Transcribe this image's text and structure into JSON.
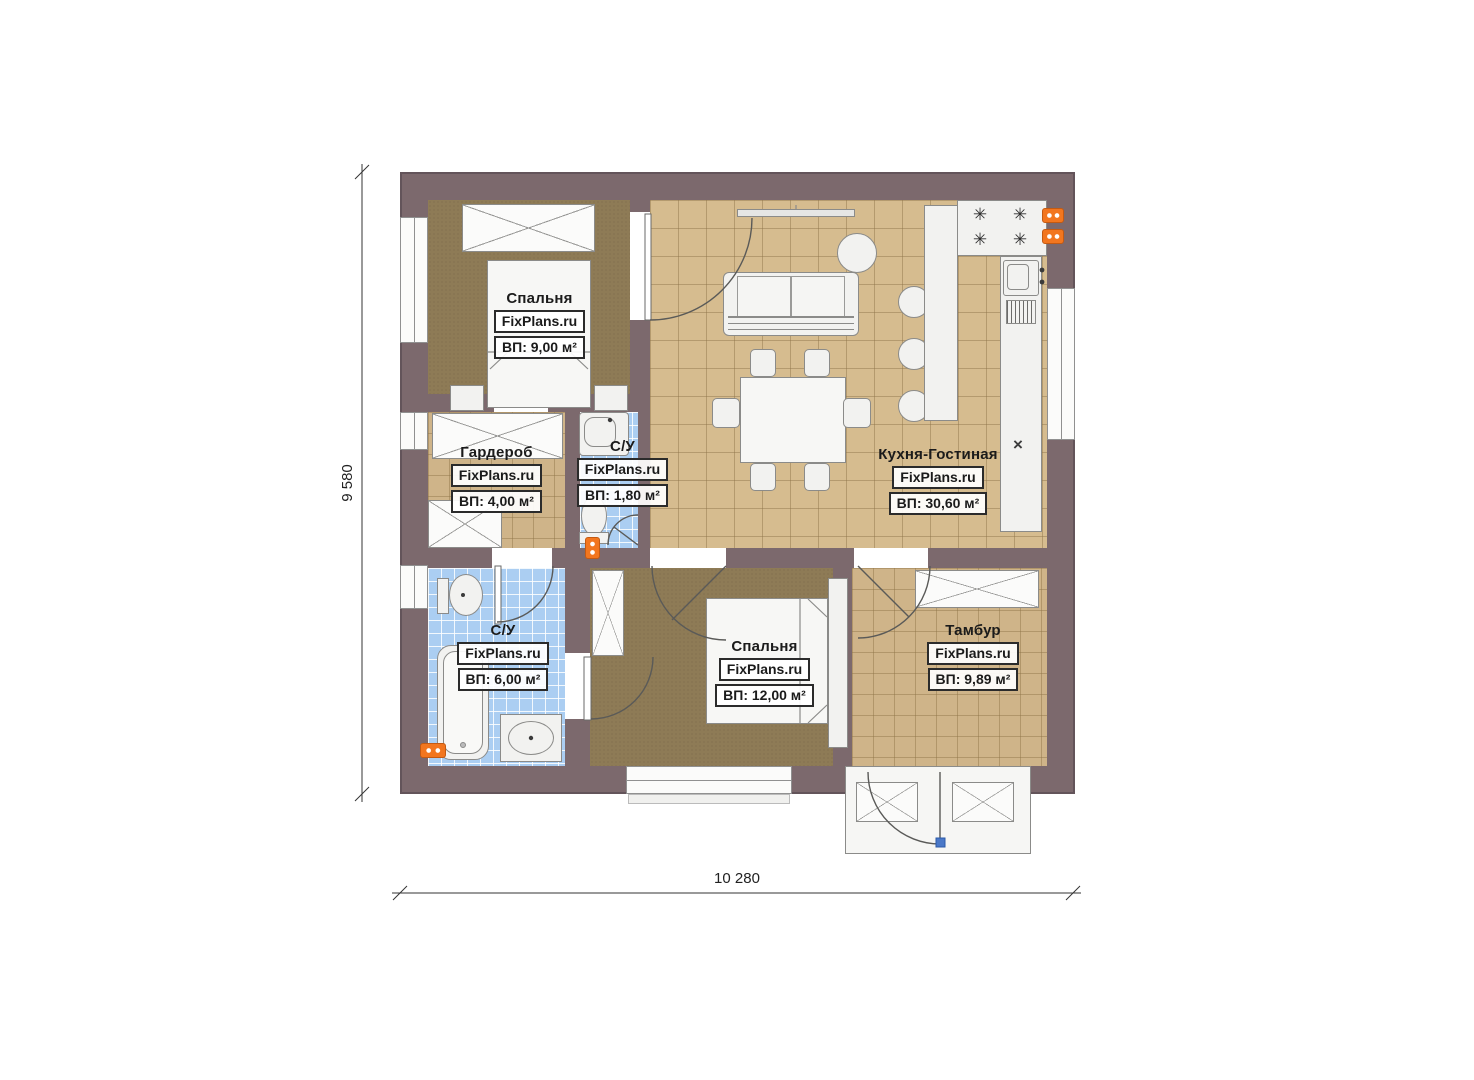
{
  "plan": {
    "brand": "FixPlans.ru",
    "dim": {
      "width": "10 280",
      "height": "9 580"
    },
    "rooms": [
      {
        "name": "Спальня",
        "area": "ВП: 9,00 м²"
      },
      {
        "name": "Гардероб",
        "area": "ВП: 4,00 м²"
      },
      {
        "name": "С/У",
        "area": "ВП: 1,80 м²"
      },
      {
        "name": "Кухня-Гостиная",
        "area": "ВП: 30,60 м²"
      },
      {
        "name": "С/У",
        "area": "ВП: 6,00 м²"
      },
      {
        "name": "Спальня",
        "area": "ВП: 12,00 м²"
      },
      {
        "name": "Тамбур",
        "area": "ВП: 9,89 м²"
      }
    ],
    "glyphs": {
      "burner": "✳",
      "cross": "×"
    },
    "colors": {
      "wall": "#7c696d",
      "tile": "#d6bc8f",
      "tile_small": "#cfb489",
      "carpet": "#8e7b56",
      "bath_tile": "#abcef2",
      "socket": "#f2761f"
    }
  }
}
